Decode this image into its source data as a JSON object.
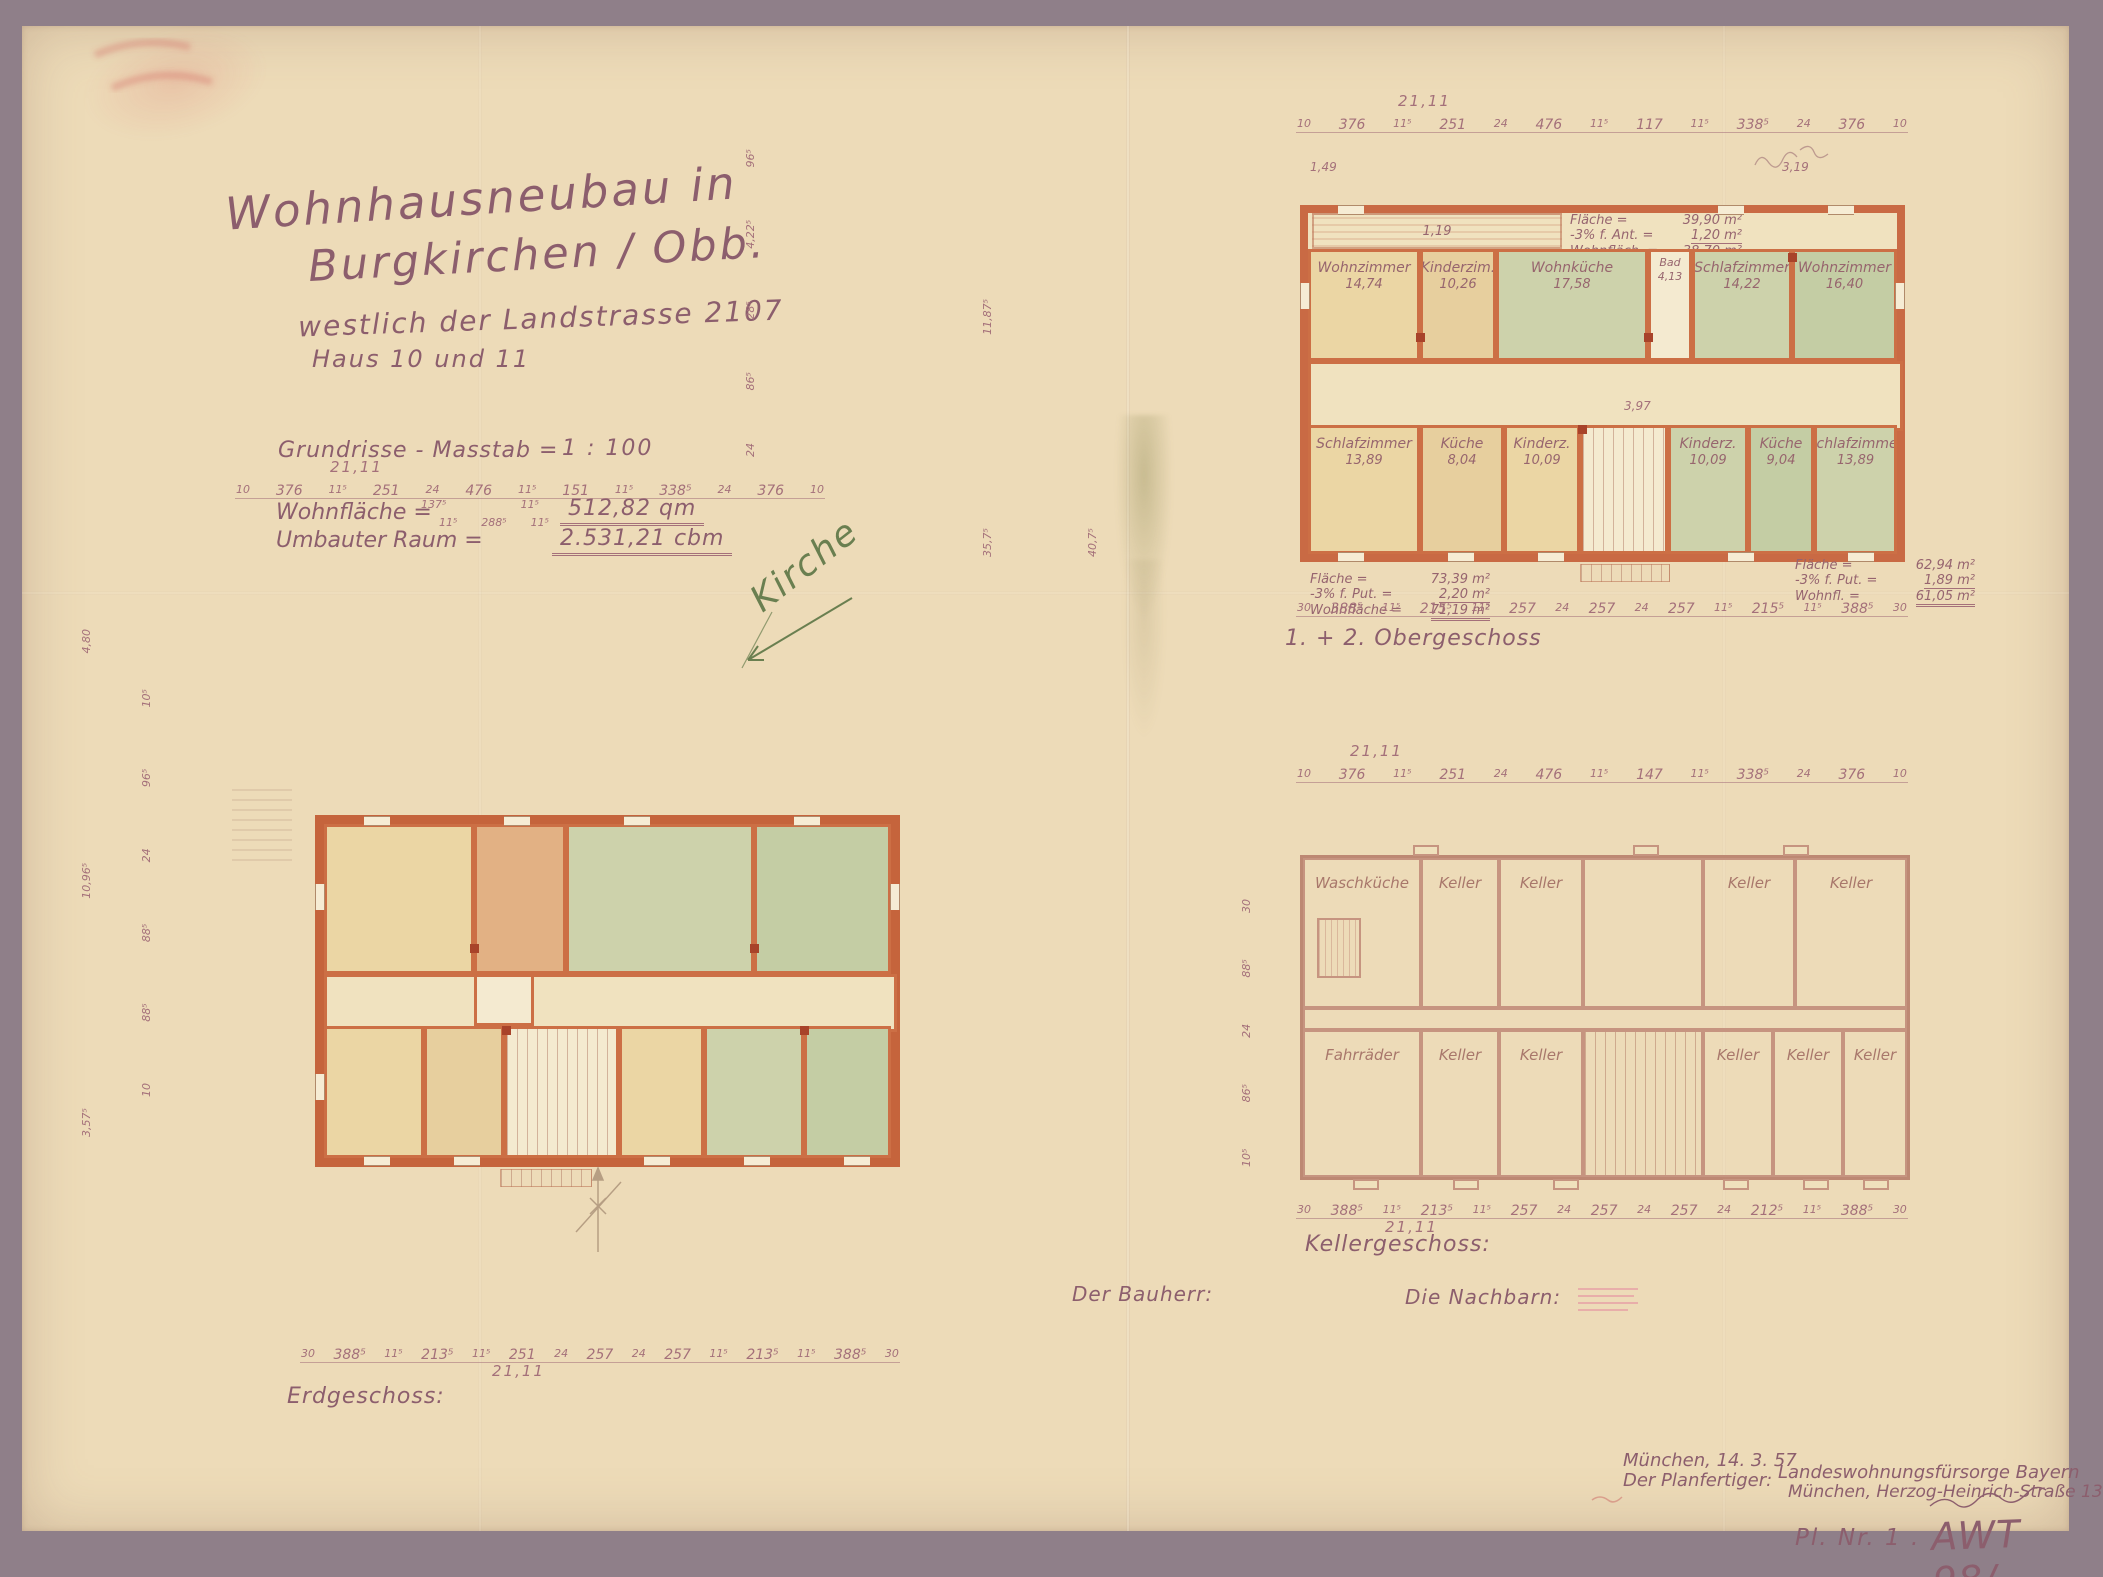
{
  "document": {
    "title_line1": "Wohnhausneubau in",
    "title_line2": "Burgkirchen / Obb.",
    "subtitle": "westlich der Landstrasse 2107",
    "houses": "Haus 10 und 11",
    "scale_label": "Grundrisse - Masstab =",
    "scale_value": "1 : 100",
    "area_label": "Wohnfläche =",
    "area_value": "512,82 qm",
    "volume_label": "Umbauter Raum =",
    "volume_value": "2.531,21 cbm",
    "annotation_green": "Kirche"
  },
  "colors": {
    "paper": "#eddbb8",
    "frame": "#8f7f89",
    "ink": "#8c5e6d",
    "wall": "#cc6f45",
    "room_cream": "#ebd6a4",
    "room_orange": "#e2b184",
    "room_green": "#cdd2ab",
    "annotation_green": "#6a7f50"
  },
  "plans": {
    "og": {
      "label": "1. + 2. Obergeschoss",
      "loggia_dim": "1,19",
      "corner_dim_left": "1,49",
      "corner_dim_right": "3,19",
      "hall_dim": "3,97",
      "stats_top": {
        "l1": "Fläche =",
        "v1": "39,90 m²",
        "l2": "-3% f. Ant. =",
        "v2": "1,20 m²",
        "l3": "Wohnfläch. =",
        "v3": "38,70 m²"
      },
      "stats_left": {
        "l1": "Fläche =",
        "v1": "73,39 m²",
        "l2": "-3% f. Put. =",
        "v2": "2,20 m²",
        "l3": "Wohnfläche =",
        "v3": "71,19 m²"
      },
      "stats_right": {
        "l1": "Fläche =",
        "v1": "62,94 m²",
        "l2": "-3% f. Put. =",
        "v2": "1,89 m²",
        "l3": "Wohnfl. =",
        "v3": "61,05 m²"
      },
      "rooms_top": [
        {
          "name": "Wohnzimmer",
          "area": "14,74"
        },
        {
          "name": "Kinderzim.",
          "area": "10,26"
        },
        {
          "name": "Wohnküche",
          "area": "17,58"
        },
        {
          "name": "Bad",
          "area": "4,13"
        },
        {
          "name": "Schlafzimmer",
          "area": "14,22"
        },
        {
          "name": "Wohnzimmer",
          "area": "16,40"
        }
      ],
      "rooms_bottom": [
        {
          "name": "Schlafzimmer",
          "area": "13,89"
        },
        {
          "name": "Küche",
          "area": "8,04"
        },
        {
          "name": "Kinderz.",
          "area": "10,09"
        },
        {
          "name": "Kinderz.",
          "area": "10,09"
        },
        {
          "name": "Küche",
          "area": "9,04"
        },
        {
          "name": "Schlafzimmer",
          "area": "13,89"
        }
      ],
      "dim_top": {
        "overall": "21,11",
        "values": [
          "10",
          "376",
          "11⁵",
          "251",
          "24",
          "476",
          "11⁵",
          "117",
          "11⁵",
          "338⁵",
          "24",
          "376",
          "10"
        ]
      },
      "dim_bottom": {
        "values": [
          "30",
          "388⁵",
          "11⁵",
          "215⁵",
          "11⁵",
          "257",
          "24",
          "257",
          "24",
          "257",
          "11⁵",
          "215⁵",
          "11⁵",
          "388⁵",
          "30"
        ]
      },
      "vdim_far": [
        "24",
        "86⁵",
        "28⁵",
        "4,22⁵",
        "96⁵"
      ],
      "vdim_near": [
        "35,7⁵",
        "11,87⁵"
      ],
      "vdim_near2": [
        "40,7⁵"
      ]
    },
    "eg": {
      "label": "Erdgeschoss:",
      "dim_top": {
        "overall": "21,11",
        "values": [
          "10",
          "376",
          "11⁵",
          "251",
          "24",
          "476",
          "11⁵",
          "151",
          "11⁵",
          "338⁵",
          "24",
          "376",
          "10"
        ],
        "sub1": [
          "137⁵",
          "11⁵"
        ],
        "sub2": [
          "11⁵",
          "288⁵",
          "11⁵"
        ]
      },
      "dim_bottom": {
        "overall": "21,11",
        "values": [
          "30",
          "388⁵",
          "11⁵",
          "213⁵",
          "11⁵",
          "251",
          "24",
          "257",
          "24",
          "257",
          "11⁵",
          "213⁵",
          "11⁵",
          "388⁵",
          "30"
        ]
      },
      "vdim1": [
        "3,57⁵",
        "10,96⁵",
        "4,80"
      ],
      "vdim2": [
        "10",
        "88⁵",
        "88⁵",
        "24",
        "96⁵",
        "10⁵"
      ]
    },
    "kg": {
      "label": "Kellergeschoss:",
      "rooms_top": [
        "Waschküche",
        "Keller",
        "Keller",
        "Keller",
        "Keller"
      ],
      "rooms_bottom": [
        "Fahrräder",
        "Keller",
        "Keller",
        "Keller",
        "Keller",
        "Keller"
      ],
      "dim_top": {
        "overall": "21,11",
        "values": [
          "10",
          "376",
          "11⁵",
          "251",
          "24",
          "476",
          "11⁵",
          "147",
          "11⁵",
          "338⁵",
          "24",
          "376",
          "10"
        ]
      },
      "dim_bottom": {
        "overall": "21,11",
        "values": [
          "30",
          "388⁵",
          "11⁵",
          "213⁵",
          "11⁵",
          "257",
          "24",
          "257",
          "24",
          "257",
          "24",
          "212⁵",
          "11⁵",
          "388⁵",
          "30"
        ]
      },
      "vdim": [
        "10⁵",
        "86⁵",
        "24",
        "88⁵",
        "30"
      ]
    }
  },
  "signatures": {
    "bauherr": "Der Bauherr:",
    "nachbarn": "Die Nachbarn:"
  },
  "footer": {
    "city_date": "München, 14. 3. 57",
    "planfertiger_label": "Der Planfertiger:",
    "org_line1": "Landeswohnungsfürsorge Bayern",
    "org_line2": "München, Herzog-Heinrich-Straße 13",
    "plan_no_label": "Pl. Nr.  1 .",
    "plan_code": "AWT 98/",
    "plan_code_sub": "10,11"
  }
}
